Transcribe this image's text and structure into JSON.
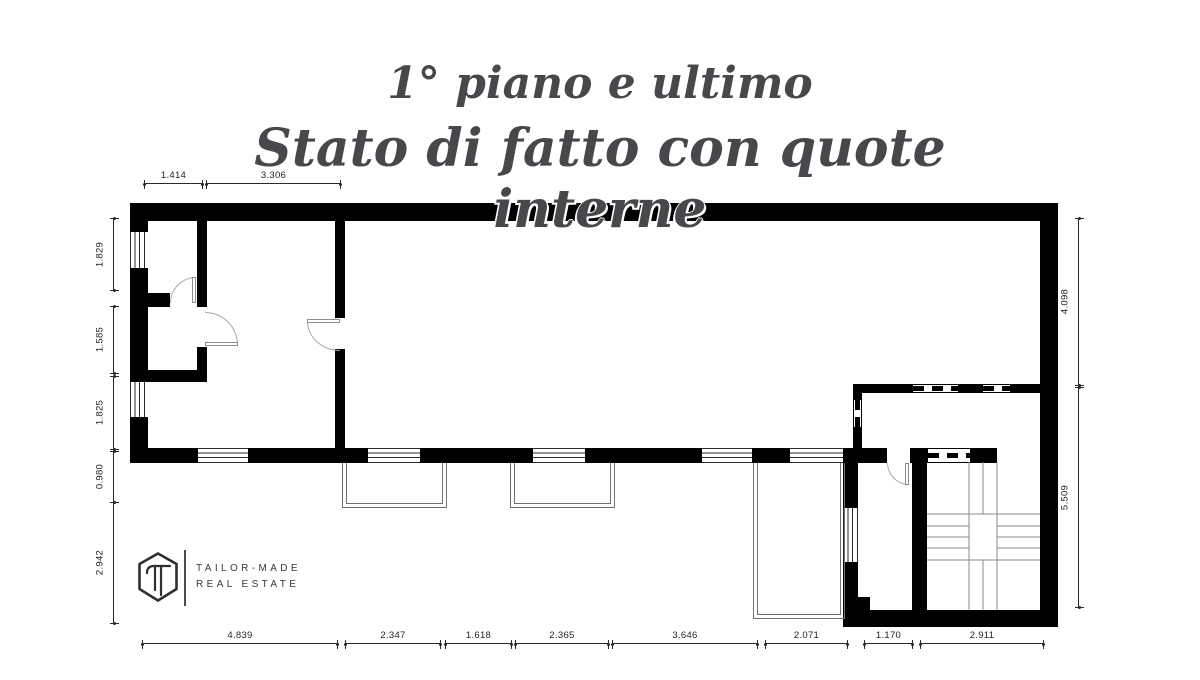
{
  "title": {
    "line1": "1° piano  e ultimo",
    "line2": "Stato di fatto con quote interne"
  },
  "logo": {
    "line1": "TAILOR-MADE",
    "line2": "REAL ESTATE"
  },
  "dimensions": {
    "top": [
      "1.414",
      "3.306"
    ],
    "left": [
      "1.829",
      "1.585",
      "1.825",
      "0.980",
      "2.942"
    ],
    "right": [
      "4.098",
      "5.509"
    ],
    "bottom": [
      "4.839",
      "2.347",
      "1.618",
      "2.365",
      "3.646",
      "2.071",
      "1.170",
      "2.911"
    ]
  },
  "colors": {
    "wall": "#000000",
    "title_text": "#48484c",
    "thin_line": "#8a8a8a",
    "dim_text": "#1f1f1f",
    "logo": "#2e2e33"
  }
}
